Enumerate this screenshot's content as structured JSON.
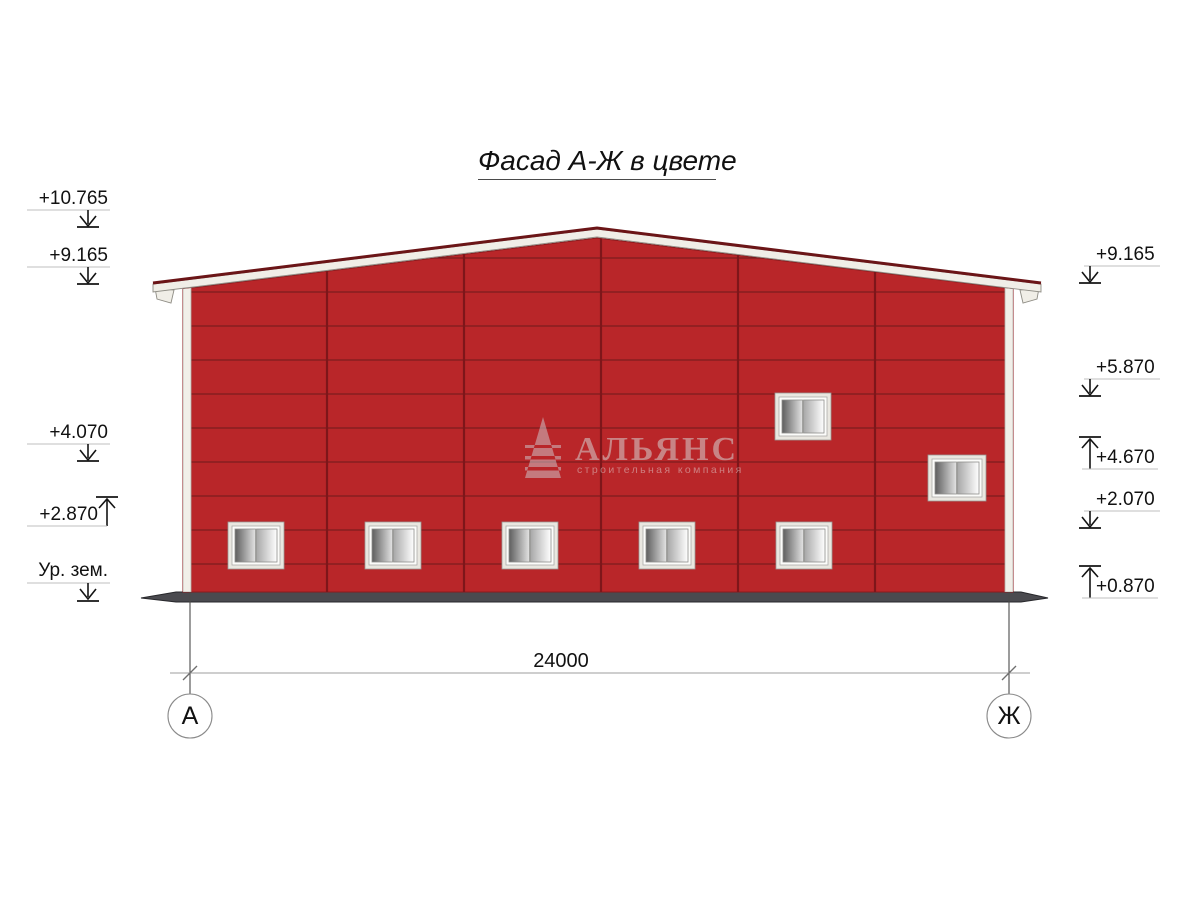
{
  "drawing": {
    "title": "Фасад А-Ж в цвете",
    "dimension_label": "24000",
    "axis_left": "А",
    "axis_right": "Ж",
    "levels_left": [
      {
        "value": "+10.765",
        "direction": "down"
      },
      {
        "value": "+9.165",
        "direction": "down"
      },
      {
        "value": "+4.070",
        "direction": "down"
      },
      {
        "value": "+2.870",
        "direction": "up"
      },
      {
        "value": "Ур. зем.",
        "direction": "down"
      }
    ],
    "levels_right": [
      {
        "value": "+9.165",
        "direction": "down"
      },
      {
        "value": "+5.870",
        "direction": "down"
      },
      {
        "value": "+4.670",
        "direction": "up"
      },
      {
        "value": "+2.070",
        "direction": "down"
      },
      {
        "value": "+0.870",
        "direction": "up"
      }
    ],
    "watermark": {
      "name": "АЛЬЯНС",
      "subtitle": "строительная компания"
    },
    "colors": {
      "wall": "#b92629",
      "panel_line": "#6d1a1c",
      "roof_edge": "#6b1517",
      "fascia": "#f0eee7",
      "ground": "#4a4a4f",
      "leader_line": "#bfbfbf",
      "marker": "#141414"
    }
  }
}
